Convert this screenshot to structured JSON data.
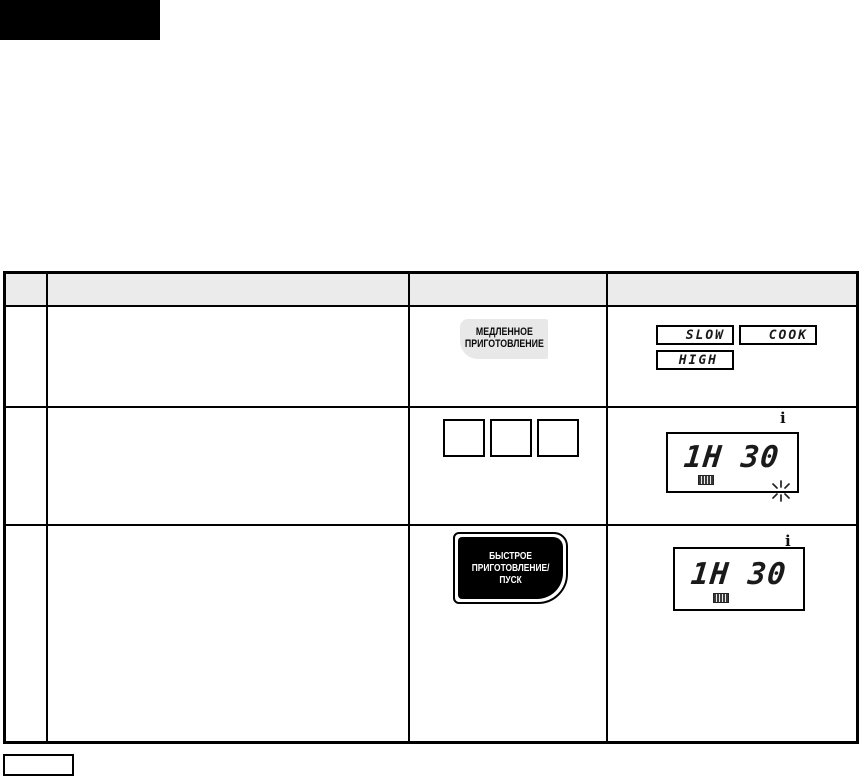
{
  "colors": {
    "ink": "#000000",
    "header_gray": "#ebebeb",
    "button_gray": "#e8e8e8"
  },
  "banner": {
    "label": ""
  },
  "table": {
    "header": {
      "col_step": "",
      "col_instruction": "",
      "col_button": "",
      "col_display": ""
    },
    "row1": {
      "step": "",
      "instruction": "",
      "button": {
        "line1": "МЕДЛЕННОЕ",
        "line2": "ПРИГОТОВЛЕНИЕ"
      },
      "display": {
        "indicator_slow": "SLOW",
        "indicator_cook": "COOK",
        "indicator_high": "HIGH"
      }
    },
    "row2": {
      "step": "",
      "instruction": "",
      "keypad": {
        "key1": "",
        "key2": "",
        "key3": ""
      },
      "display": {
        "time": "1H 30",
        "info_icon": "i"
      }
    },
    "row3": {
      "step": "",
      "instruction": "",
      "button": {
        "line1": "БЫСТРОЕ",
        "line2": "ПРИГОТОВЛЕНИЕ/",
        "line3": "ПУСК"
      },
      "display": {
        "time": "1H 30",
        "info_icon": "i"
      }
    }
  },
  "footer": {
    "note_label": ""
  }
}
